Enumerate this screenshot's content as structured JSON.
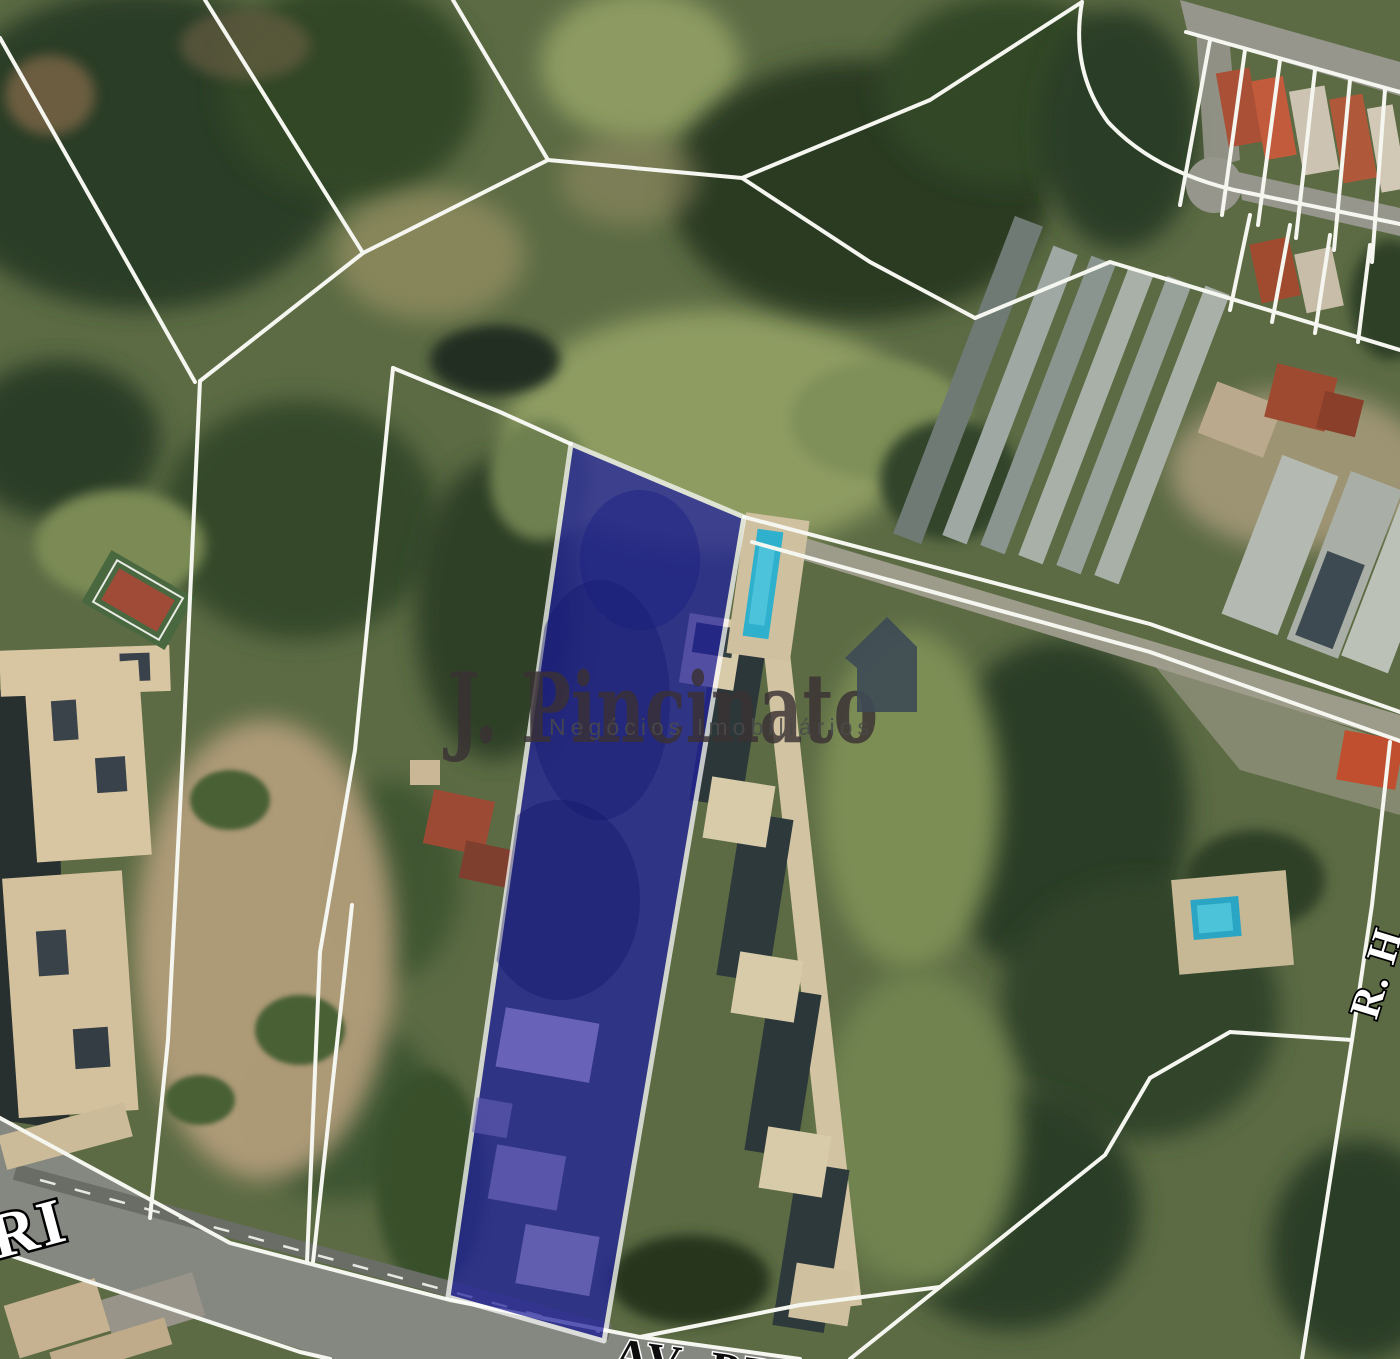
{
  "map": {
    "description": "Aerial satellite view of land parcels outlined with white boundary lines",
    "highlighted_parcel": {
      "label": "highlighted lot for sale",
      "fill_color": "#1f1f9e",
      "border_color": "#ffffff"
    }
  },
  "watermark": {
    "title": "J. Pincinato",
    "subtitle": "Negócios Imobiliários",
    "logo": "house-icon",
    "title_color": "#3a3134",
    "subtitle_color": "#4a4a4a"
  },
  "street_labels": {
    "left": "RI",
    "bottom": "AV. PR",
    "right": "R. H"
  }
}
